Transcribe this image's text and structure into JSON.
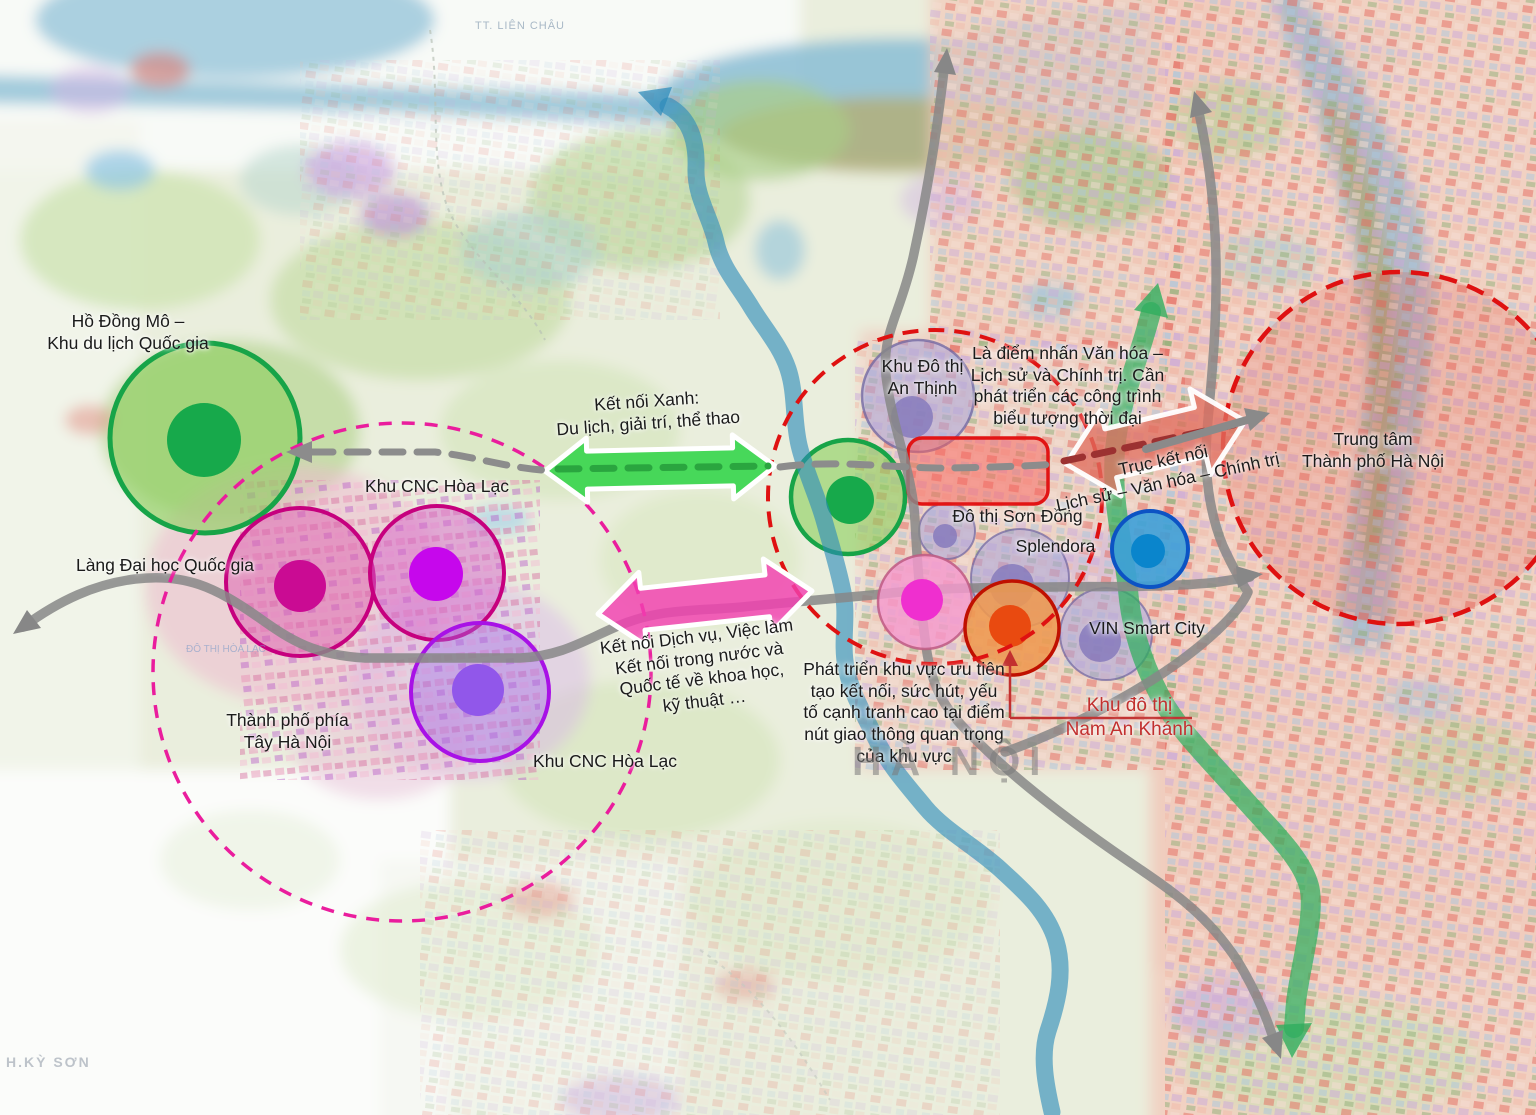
{
  "labels": {
    "ho_dong_mo": {
      "text": "Hồ Đồng Mô –\nKhu du lịch Quốc gia"
    },
    "cnc_top": {
      "text": "Khu CNC Hòa Lạc"
    },
    "lang_dai_hoc": {
      "text": "Làng Đại học Quốc gia"
    },
    "tp_tay": {
      "text": "Thành phố phía\nTây Hà Nội"
    },
    "cnc_bottom": {
      "text": "Khu CNC Hòa Lạc"
    },
    "ket_noi_xanh": {
      "text": "Kết nối Xanh:\nDu lịch, giải trí, thể thao"
    },
    "ket_noi_dichvu": {
      "text": "Kết nối Dịch vụ, Việc làm\nKết nối trong nước và\nQuốc tế về khoa học,\nkỹ thuật …"
    },
    "an_thinh": {
      "text": "Khu Đô thị\nAn Thịnh"
    },
    "la_diem_nhan": {
      "text": "Là điểm nhấn Văn hóa –\nLịch sử và Chính trị. Cần\nphát triển các công trình\nbiểu tượng thời đại"
    },
    "son_dong": {
      "text": "Đô thị Sơn Đồng"
    },
    "splendora": {
      "text": "Splendora"
    },
    "truc_ket_noi": {
      "text": "Trục kết nối\nLịch sử – Văn hóa – Chính trị"
    },
    "trung_tam": {
      "text": "Trung tâm\nThành phố Hà Nội"
    },
    "vin": {
      "text": "VIN Smart City"
    },
    "phat_trien": {
      "text": "Phát triển khu vực ưu tiên\ntạo kết nối, sức hút, yếu\ntố cạnh tranh cao tại điểm\nnút giao thông quan trọng\ncủa khu vực"
    },
    "nam_an_khanh": {
      "text": "Khu đô thị\nNam An Khánh"
    },
    "ha_noi": {
      "text": "HÀ NỘI"
    },
    "tt_lien_chau": {
      "text": "TT. LIÊN CHÂU"
    },
    "h_ky_son": {
      "text": "H.KỲ SƠN"
    },
    "do_thi_hoa_lac": {
      "text": "ĐÔ THỊ HÒA LẠC"
    }
  },
  "colors": {
    "green_zone": "#17a448",
    "magenta_zone": "#c6007e",
    "purple_zone": "#a811e6",
    "red_ring": "#df1111",
    "pink_ring": "#ea1d9d",
    "blue_node": "#0c53c4",
    "orange_node": "#c01000",
    "road_gray": "#878787",
    "label_red": "#c2302f",
    "green_arrow": "#3ed652",
    "pink_arrow": "#f340b1",
    "salmon_arrow": "#e0705f"
  },
  "overlay": {
    "tint_circle": {
      "id": "hanoi-center-tint",
      "cx": 1399,
      "cy": 448,
      "r": 176,
      "fill": "rgba(222,60,50,0.17)"
    },
    "under_circles": [
      {
        "id": "zone-ho-dong-mo",
        "cx": 205,
        "cy": 438,
        "r": 95,
        "fill": "rgba(141,206,93,0.62)",
        "stroke": "#17a448",
        "sw": 5,
        "inner": {
          "cx": 204,
          "cy": 440,
          "r": 37,
          "fill": "#17a94b"
        }
      },
      {
        "id": "zone-green-hub",
        "cx": 848,
        "cy": 497,
        "r": 57,
        "fill": "rgba(141,206,93,0.62)",
        "stroke": "#17a448",
        "sw": 4.5,
        "inner": {
          "cx": 850,
          "cy": 500,
          "r": 24,
          "fill": "#17a94b"
        }
      },
      {
        "id": "zone-cnc-west",
        "cx": 300,
        "cy": 582,
        "r": 74,
        "fill": "rgba(219,93,175,0.5)",
        "stroke": "#c6007e",
        "sw": 4,
        "inner": {
          "cx": 300,
          "cy": 586,
          "r": 26,
          "fill": "#ca0b93"
        }
      },
      {
        "id": "zone-cnc-east",
        "cx": 437,
        "cy": 573,
        "r": 67,
        "fill": "rgba(214,99,201,0.5)",
        "stroke": "#c6007e",
        "sw": 4,
        "inner": {
          "cx": 436,
          "cy": 574,
          "r": 27,
          "fill": "#c607ec"
        }
      },
      {
        "id": "zone-cnc-south",
        "cx": 480,
        "cy": 692,
        "r": 69,
        "fill": "rgba(164,106,232,0.42)",
        "stroke": "#a811e6",
        "sw": 4,
        "inner": {
          "cx": 478,
          "cy": 690,
          "r": 26,
          "fill": "#9157ea"
        }
      },
      {
        "id": "zone-an-thinh",
        "cx": 918,
        "cy": 396,
        "r": 56,
        "fill": "rgba(173,166,216,0.6)",
        "stroke": "rgba(110,100,160,0.75)",
        "sw": 2.5,
        "inner": {
          "cx": 912,
          "cy": 417,
          "r": 21,
          "fill": "rgba(134,122,188,0.85)"
        }
      },
      {
        "id": "zone-son-dong",
        "cx": 947,
        "cy": 531,
        "r": 28,
        "fill": "rgba(173,166,216,0.6)",
        "stroke": "rgba(110,100,160,0.7)",
        "sw": 2,
        "inner": {
          "cx": 945,
          "cy": 536,
          "r": 12,
          "fill": "rgba(134,122,188,0.85)"
        }
      },
      {
        "id": "zone-splendora",
        "cx": 1020,
        "cy": 578,
        "r": 49,
        "fill": "rgba(173,166,216,0.6)",
        "stroke": "rgba(110,100,160,0.7)",
        "sw": 2,
        "inner": {
          "cx": 1012,
          "cy": 586,
          "r": 22,
          "fill": "rgba(134,122,188,0.85)"
        }
      },
      {
        "id": "zone-vin-smart-city",
        "cx": 1106,
        "cy": 634,
        "r": 46,
        "fill": "rgba(173,166,216,0.6)",
        "stroke": "rgba(110,100,160,0.7)",
        "sw": 2,
        "inner": {
          "cx": 1100,
          "cy": 641,
          "r": 21,
          "fill": "rgba(134,122,188,0.85)"
        }
      }
    ],
    "rect": {
      "id": "son-dong-priority-rect",
      "x": 908,
      "y": 438,
      "w": 140,
      "h": 66,
      "rx": 14,
      "fill": "rgba(250,95,90,0.5)",
      "stroke": "#e21414",
      "sw": 3.5
    },
    "ribbon": {
      "id": "green-corridor",
      "d": "M 1151,312 C 1139,360 1119,402 1115,450 C 1111,500 1123,542 1128,590 C 1131,626 1142,662 1160,696 C 1177,728 1207,757 1237,791 C 1269,828 1301,856 1309,886 C 1316,913 1301,962 1296,1002 L 1294,1028",
      "stroke": "rgba(47,174,94,0.72)",
      "sw": 20
    },
    "ribbon_heads": [
      {
        "id": "green-corridor-arrowhead-top",
        "points": "1158,283 1168,318 1134,310",
        "fill": "rgba(47,174,94,0.8)"
      },
      {
        "id": "green-corridor-arrowhead-bottom",
        "points": "1292,1058 1312,1023 1276,1025",
        "fill": "rgba(47,174,94,0.8)"
      }
    ],
    "river_arrow": {
      "id": "blue-river-arrow",
      "d": "M 668,106 C 690,118 697,142 696,168 C 695,196 710,216 716,242 C 721,266 737,284 750,305 C 763,327 780,345 788,369 C 796,393 793,419 799,445 C 805,471 817,495 824,520 C 831,545 838,567 843,592 C 848,617 841,642 846,667 C 851,693 864,714 876,739 C 888,764 906,784 925,807 C 944,830 976,847 1000,869 C 1024,891 1047,911 1056,941 C 1065,971 1058,1001 1048,1031 C 1040,1056 1046,1086 1052,1112",
      "stroke": "rgba(44,138,186,0.62)",
      "sw": 17
    },
    "river_head": {
      "id": "blue-river-arrowhead",
      "points": "638,92 672,87 661,116",
      "fill": "rgba(44,138,186,0.72)"
    },
    "roads": [
      {
        "id": "road-west-east",
        "d": "M 23,627 C 60,600 95,584 135,579 C 185,573 215,587 258,617 C 293,642 315,655 365,658 L 520,658 C 562,656 585,640 618,626 C 660,608 700,611 742,607 C 800,601 832,599 882,594 C 940,587 985,588 1045,587 C 1105,586 1165,588 1218,582 L 1250,577"
      },
      {
        "id": "road-north-southeast",
        "d": "M 945,62 C 938,122 930,180 913,258 C 899,318 882,332 886,376 C 893,432 912,470 915,520 C 917,560 920,602 926,646 C 932,692 947,712 977,741 C 1012,776 1062,815 1112,850 C 1162,885 1202,907 1237,960 C 1259,996 1269,1024 1276,1047"
      },
      {
        "id": "road-north-crossing",
        "d": "M 1197,104 C 1208,152 1215,205 1216,262 C 1217,332 1211,382 1207,432 C 1204,472 1209,512 1223,546 C 1233,568 1243,585 1248,592 C 1240,612 1205,645 1163,673 C 1122,700 1062,732 1005,752"
      }
    ],
    "road_heads": [
      {
        "id": "road-arrowhead-southwest",
        "points": "13,634 27,610 41,628",
        "fill": "#878787"
      },
      {
        "id": "road-arrowhead-east",
        "points": "1263,574 1238,588 1236,566",
        "fill": "#878787"
      },
      {
        "id": "road-arrowhead-north-1",
        "points": "947,48 956,75 934,72",
        "fill": "#878787"
      },
      {
        "id": "road-arrowhead-southeast",
        "points": "1281,1059 1262,1038 1283,1030",
        "fill": "#878787"
      },
      {
        "id": "road-arrowhead-north-2",
        "points": "1194,91 1212,112 1190,118",
        "fill": "#878787"
      }
    ],
    "top_circles": [
      {
        "id": "node-pink",
        "cx": 925,
        "cy": 602,
        "r": 47,
        "fill": "rgba(244,154,205,0.82)",
        "stroke": "rgba(190,90,130,0.85)",
        "sw": 2.5,
        "inner": {
          "cx": 922,
          "cy": 600,
          "r": 21,
          "fill": "#ef2fcf"
        }
      },
      {
        "id": "node-nam-an-khanh",
        "cx": 1012,
        "cy": 628,
        "r": 47,
        "fill": "rgba(238,152,80,0.88)",
        "stroke": "#c01000",
        "sw": 3.5,
        "inner": {
          "cx": 1010,
          "cy": 626,
          "r": 21,
          "fill": "#e94a10"
        }
      },
      {
        "id": "node-blue",
        "cx": 1150,
        "cy": 549,
        "r": 38,
        "fill": "rgba(61,160,216,0.9)",
        "stroke": "#0c53c4",
        "sw": 4,
        "inner": {
          "cx": 1148,
          "cy": 551,
          "r": 17,
          "fill": "#0a85cc"
        }
      }
    ],
    "dashed_circles": [
      {
        "id": "ring-west-development",
        "cx": 402,
        "cy": 672,
        "r": 249,
        "stroke": "#ea1d9d",
        "sw": 3.5,
        "dash": "13 10"
      },
      {
        "id": "ring-central-priority",
        "cx": 935,
        "cy": 497,
        "r": 167,
        "stroke": "#df1111",
        "sw": 4,
        "dash": "16 10"
      },
      {
        "id": "ring-hanoi-center",
        "cx": 1399,
        "cy": 448,
        "r": 176,
        "stroke": "#df1111",
        "sw": 4.5,
        "dash": "18 11"
      }
    ],
    "fat_arrows": [
      {
        "id": "arrow-green-connect",
        "x1": 545,
        "y1": 471,
        "x2": 775,
        "y2": 466,
        "bw": 19,
        "hw": 32,
        "hl": 42,
        "fill": "rgba(62,214,82,0.95)",
        "stroke": "#ffffff",
        "sw": 5
      },
      {
        "id": "arrow-pink-connect",
        "x1": 598,
        "y1": 614,
        "x2": 812,
        "y2": 591,
        "bw": 21,
        "hw": 37,
        "hl": 45,
        "fill": "rgba(243,64,177,0.82)",
        "stroke": "#ffffff",
        "sw": 5
      },
      {
        "id": "arrow-axis-connect",
        "x1": 1066,
        "y1": 464,
        "x2": 1245,
        "y2": 421,
        "bw": 25,
        "hw": 44,
        "hl": 46,
        "fill": "rgba(224,112,96,0.78)",
        "stroke": "rgba(255,255,255,0.95)",
        "sw": 5
      }
    ],
    "routes": [
      {
        "id": "route-dashed-west",
        "d": "M 312,452 L 435,452 C 472,456 505,467 542,470",
        "stroke": "#8c8c8c",
        "sw": 7,
        "dash": "21 14"
      },
      {
        "id": "route-dashed-green",
        "d": "M 558,469 L 768,466",
        "stroke": "#2aa53f",
        "sw": 7,
        "dash": "21 14"
      },
      {
        "id": "route-dashed-mid",
        "d": "M 780,467 C 840,459 900,469 950,468 C 1000,467 1030,466 1056,464",
        "stroke": "#8c8c8c",
        "sw": 7,
        "dash": "21 14"
      },
      {
        "id": "route-dashed-axis",
        "d": "M 1064,461 L 1238,424",
        "stroke": "#9c3131",
        "sw": 7,
        "dash": "19 12"
      },
      {
        "id": "axis-gray-arrow",
        "d": "M 1146,449 L 1254,418",
        "stroke": "#8a8a8a",
        "sw": 8,
        "dash": ""
      }
    ],
    "route_heads": [
      {
        "id": "route-dashed-arrowhead-west",
        "points": "286,452 312,441 312,463",
        "fill": "#8c8c8c"
      },
      {
        "id": "axis-gray-arrowhead",
        "points": "1270,413 1250,431 1244,408",
        "fill": "#8a8a8a"
      }
    ],
    "connector": {
      "id": "nam-an-khanh-connector",
      "d": "M 1010,718 L 1192,718 M 1010,718 L 1010,660",
      "stroke": "#c2302f",
      "sw": 2.5,
      "head": "1010,650 1002,666 1018,666"
    }
  }
}
